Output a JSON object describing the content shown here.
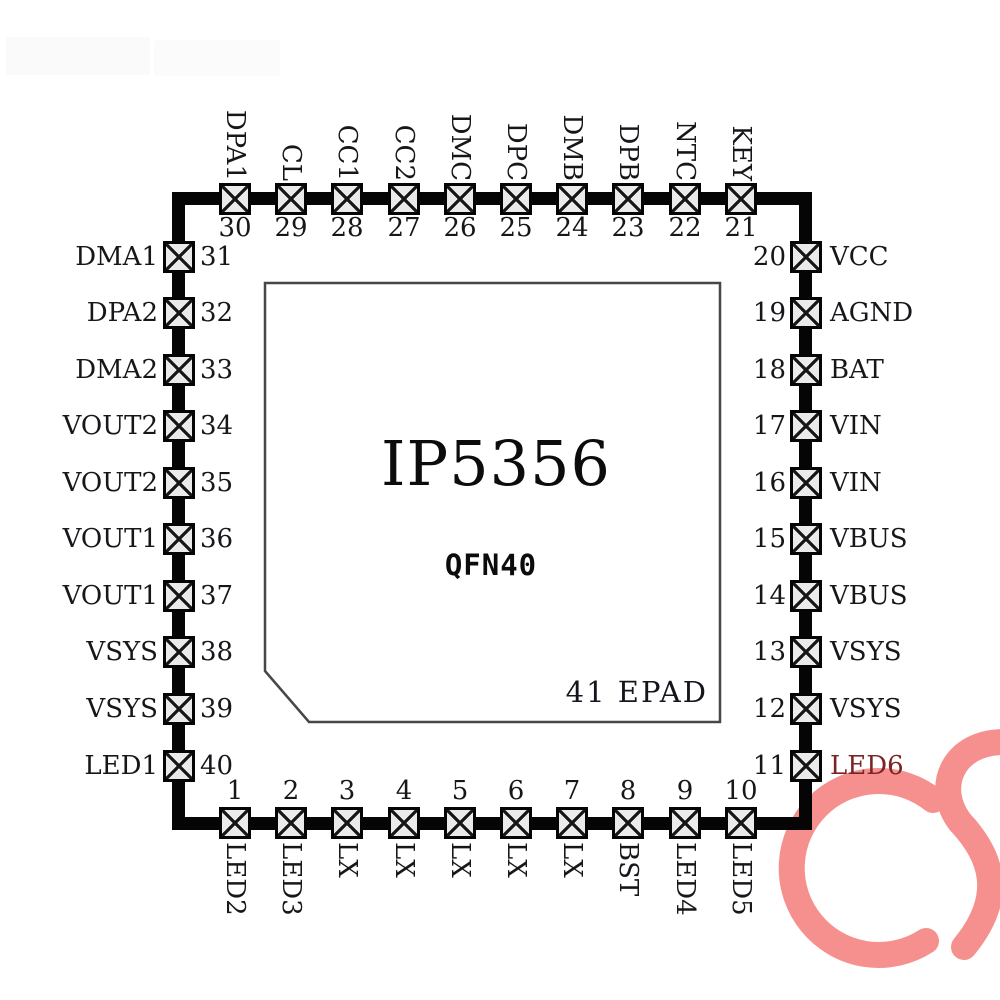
{
  "chip": {
    "part_number": "IP5356",
    "package": "QFN40",
    "epad_label": "41 EPAD"
  },
  "pins": {
    "top": [
      {
        "num": "30",
        "label": "DPA1"
      },
      {
        "num": "29",
        "label": "CL"
      },
      {
        "num": "28",
        "label": "CC1"
      },
      {
        "num": "27",
        "label": "CC2"
      },
      {
        "num": "26",
        "label": "DMC"
      },
      {
        "num": "25",
        "label": "DPC"
      },
      {
        "num": "24",
        "label": "DMB"
      },
      {
        "num": "23",
        "label": "DPB"
      },
      {
        "num": "22",
        "label": "NTC"
      },
      {
        "num": "21",
        "label": "KEY"
      }
    ],
    "left": [
      {
        "num": "31",
        "label": "DMA1"
      },
      {
        "num": "32",
        "label": "DPA2"
      },
      {
        "num": "33",
        "label": "DMA2"
      },
      {
        "num": "34",
        "label": "VOUT2"
      },
      {
        "num": "35",
        "label": "VOUT2"
      },
      {
        "num": "36",
        "label": "VOUT1"
      },
      {
        "num": "37",
        "label": "VOUT1"
      },
      {
        "num": "38",
        "label": "VSYS"
      },
      {
        "num": "39",
        "label": "VSYS"
      },
      {
        "num": "40",
        "label": "LED1"
      }
    ],
    "right": [
      {
        "num": "20",
        "label": "VCC"
      },
      {
        "num": "19",
        "label": "AGND"
      },
      {
        "num": "18",
        "label": "BAT"
      },
      {
        "num": "17",
        "label": "VIN"
      },
      {
        "num": "16",
        "label": "VIN"
      },
      {
        "num": "15",
        "label": "VBUS"
      },
      {
        "num": "14",
        "label": "VBUS"
      },
      {
        "num": "13",
        "label": "VSYS"
      },
      {
        "num": "12",
        "label": "VSYS"
      },
      {
        "num": "11",
        "label": "LED6"
      }
    ],
    "bottom": [
      {
        "num": "1",
        "label": "LED2"
      },
      {
        "num": "2",
        "label": "LED3"
      },
      {
        "num": "3",
        "label": "LX"
      },
      {
        "num": "4",
        "label": "LX"
      },
      {
        "num": "5",
        "label": "LX"
      },
      {
        "num": "6",
        "label": "LX"
      },
      {
        "num": "7",
        "label": "LX"
      },
      {
        "num": "8",
        "label": "BST"
      },
      {
        "num": "9",
        "label": "LED4"
      },
      {
        "num": "10",
        "label": "LED5"
      }
    ]
  },
  "watermark": {
    "text": "CS",
    "color": "#f6908f"
  }
}
